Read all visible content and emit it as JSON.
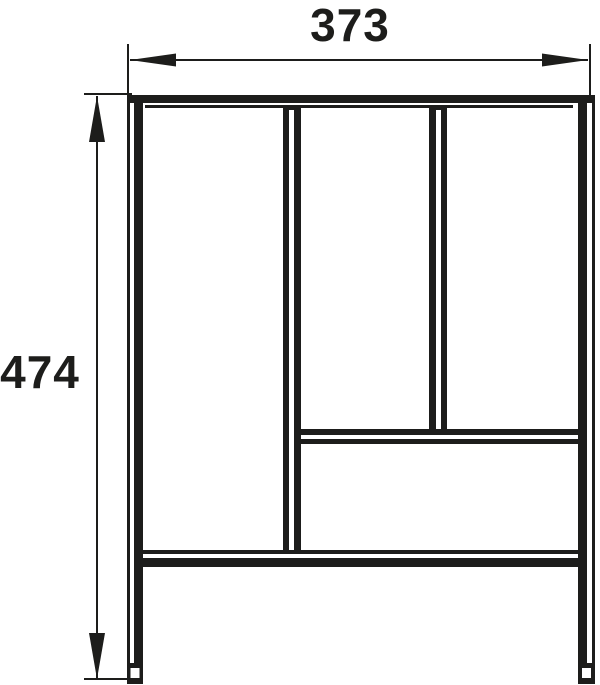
{
  "figure": {
    "type": "dimensioned technical line drawing",
    "subject": "rectangular frame front view with two vertical dividers, one mid horizontal divider and one bottom horizontal rail on two legs",
    "ink_color": "#1d1d1b",
    "background_color": "#ffffff",
    "dimensions": {
      "width": {
        "label": "373",
        "value": 373,
        "orientation": "horizontal",
        "position": "top"
      },
      "height": {
        "label": "474",
        "value": 474,
        "orientation": "vertical",
        "position": "left"
      }
    }
  }
}
